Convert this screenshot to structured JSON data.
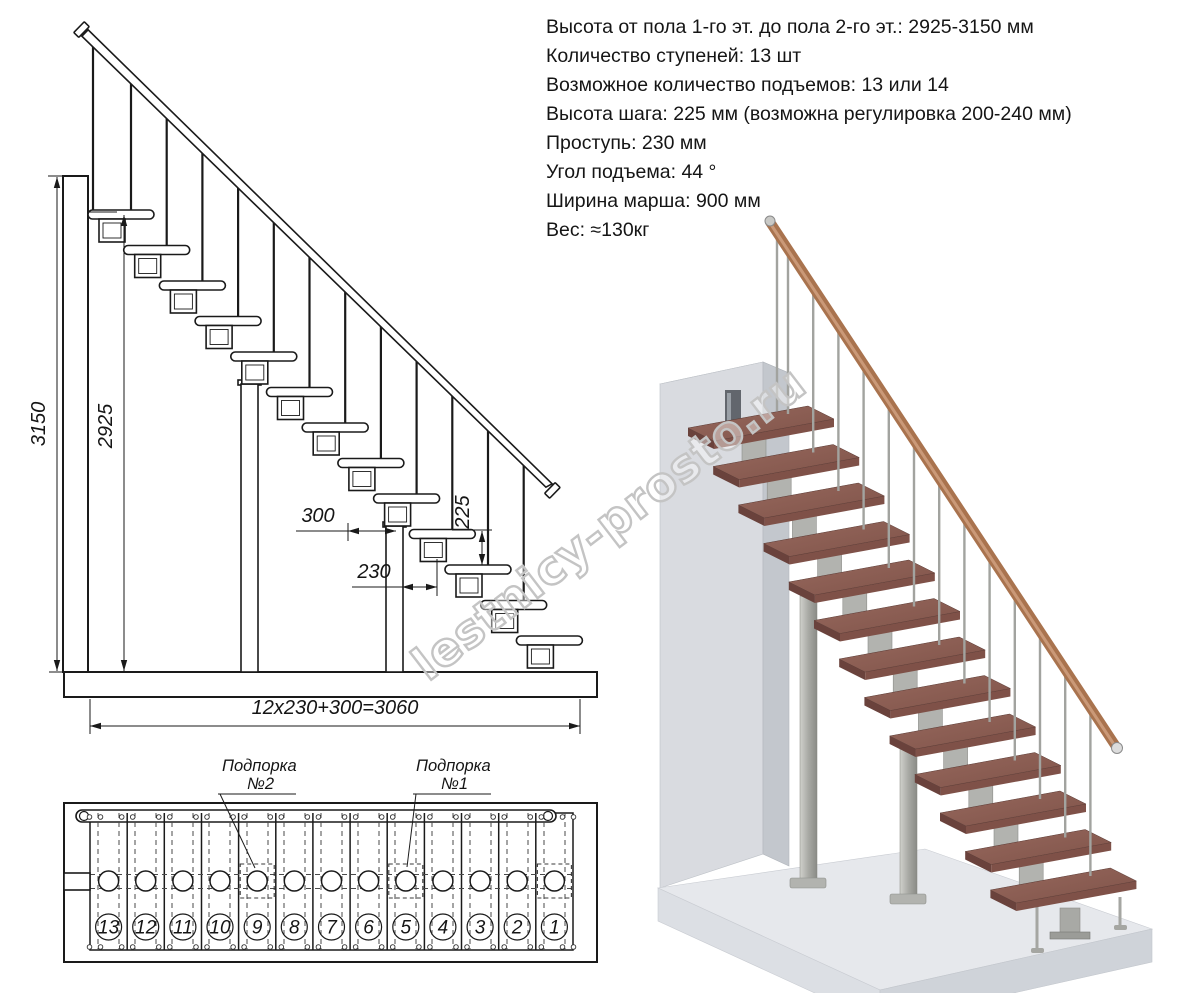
{
  "watermark": {
    "text": "lestnicy-prosto.ru"
  },
  "specs": {
    "lines": [
      "Высота от пола 1-го эт. до пола 2-го эт.: 2925-3150 мм",
      "Количество ступеней: 13 шт",
      "Возможное количество подъемов: 13 или 14",
      "Высота шага: 225 мм (возможна регулировка 200-240 мм)",
      "Проступь: 230 мм",
      "Угол подъема: 44 °",
      "Ширина марша: 900 мм",
      "Вес: ≈130кг"
    ]
  },
  "elevation": {
    "dims": {
      "total_height": "3150",
      "clear_height": "2925",
      "landing_depth": "300",
      "tread_depth": "230",
      "step_rise": "225",
      "total_run": "12x230+300=3060"
    }
  },
  "plan": {
    "callouts": {
      "support2_title": "Подпорка",
      "support2_num": "№2",
      "support1_title": "Подпорка",
      "support1_num": "№1"
    },
    "step_numbers": [
      "13",
      "12",
      "11",
      "10",
      "9",
      "8",
      "7",
      "6",
      "5",
      "4",
      "3",
      "2",
      "1"
    ]
  },
  "colors": {
    "tread_top": "#8d6055",
    "tread_front": "#6a423c",
    "handrail": "#a9734e",
    "metal": "#b2b3af",
    "wall": "#d9dbe0",
    "floor": "#e6e8ec",
    "line": "#1a1a1a",
    "watermark_stroke": "#c4c4c4"
  }
}
